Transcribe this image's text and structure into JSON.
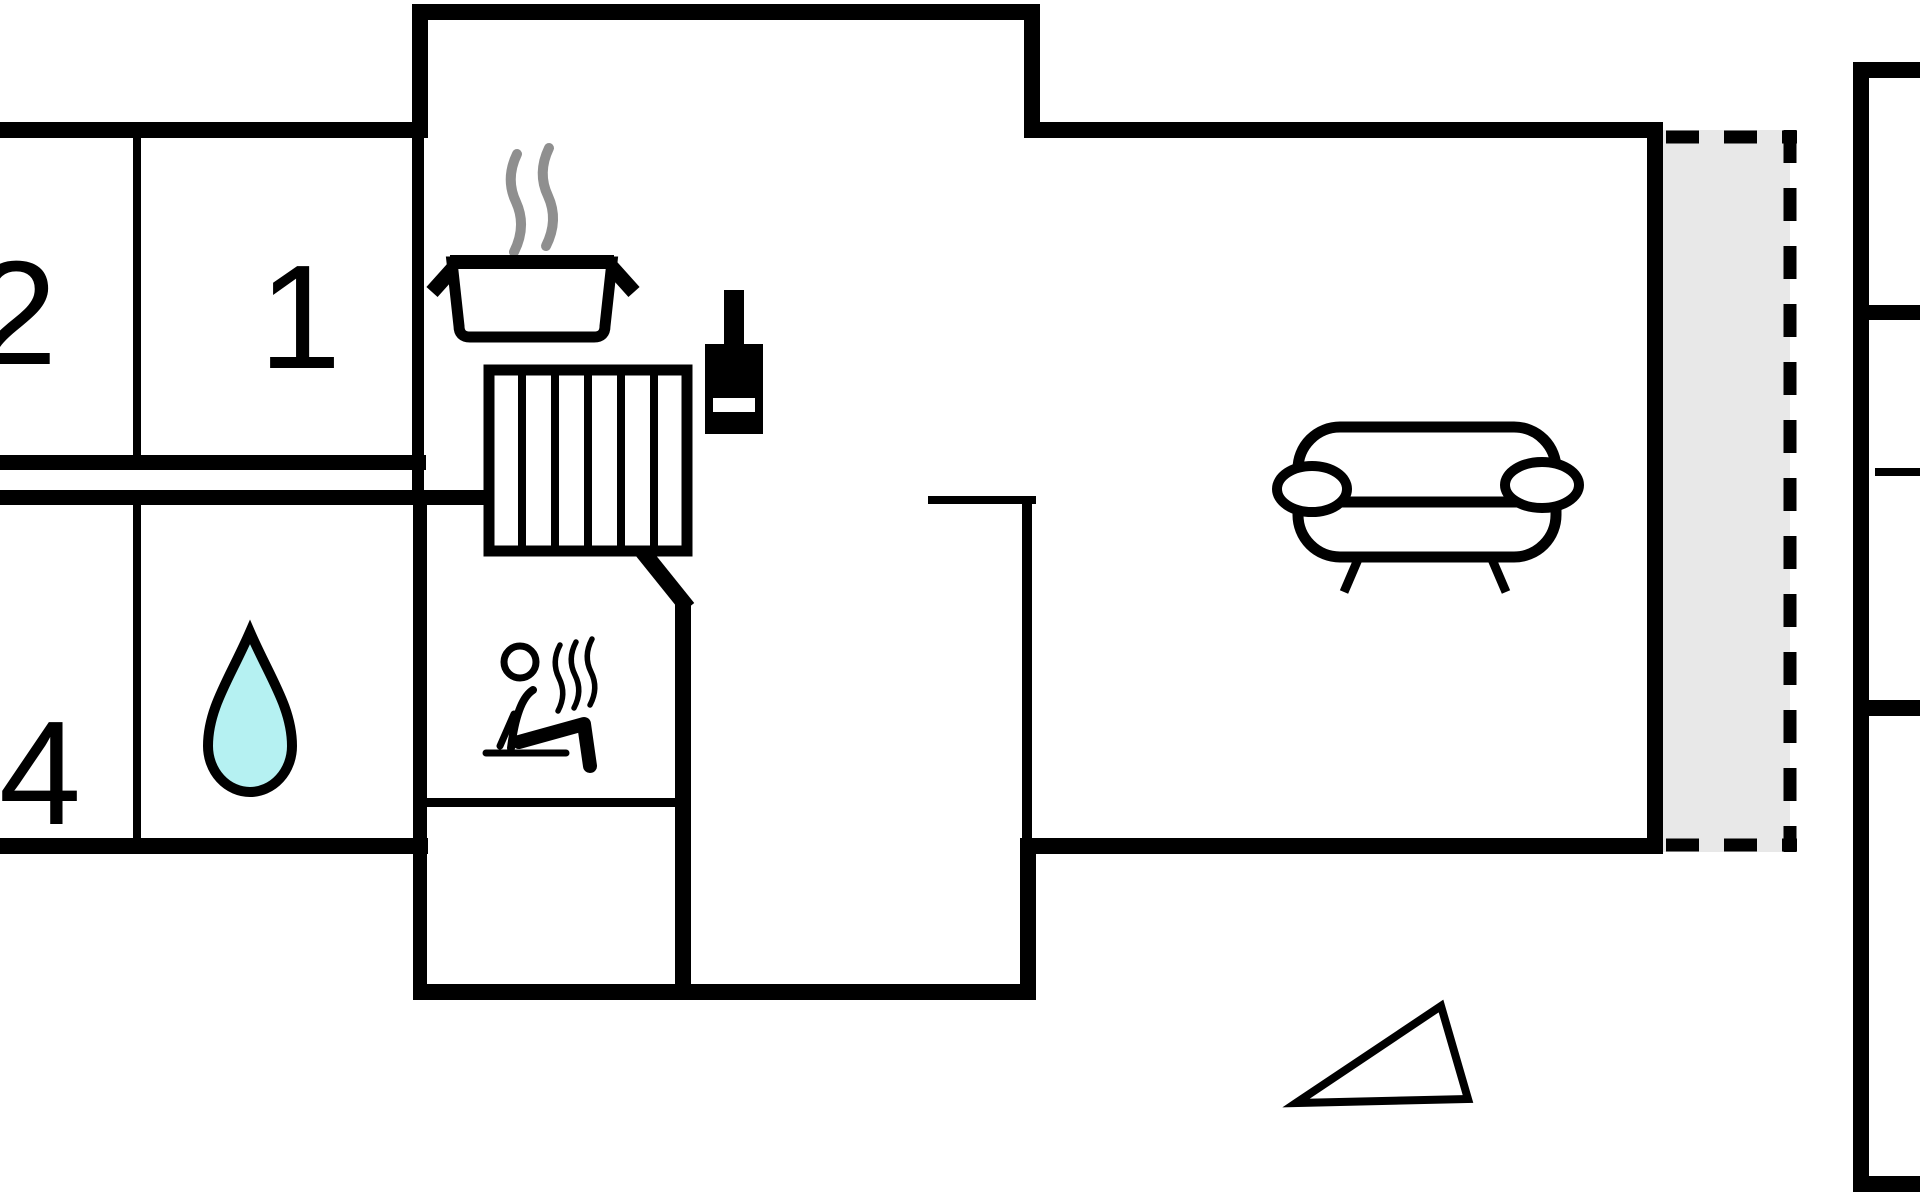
{
  "plan": {
    "type": "holiday-home floor plan",
    "rooms": {
      "bedroom1": {
        "label": "1"
      },
      "bedroom2": {
        "label": "2"
      },
      "bedroom4": {
        "label": "4"
      }
    },
    "icons": {
      "water_drop": "bathroom-water-drop",
      "sauna_person": "sauna-person-with-heat-waves",
      "cooking_pot": "steaming-pot-kitchen",
      "wood_stove": "wood-burning-stove",
      "stairs": "striped-stairs-block",
      "sofa": "sofa-top-view",
      "north_arrow": "direction-triangle"
    },
    "colors": {
      "wall": "#000000",
      "water_drop_fill": "#b5f1f2",
      "terrace_fill": "#e8e8e8",
      "steam": "#8f8f8f",
      "background": "#ffffff"
    }
  }
}
